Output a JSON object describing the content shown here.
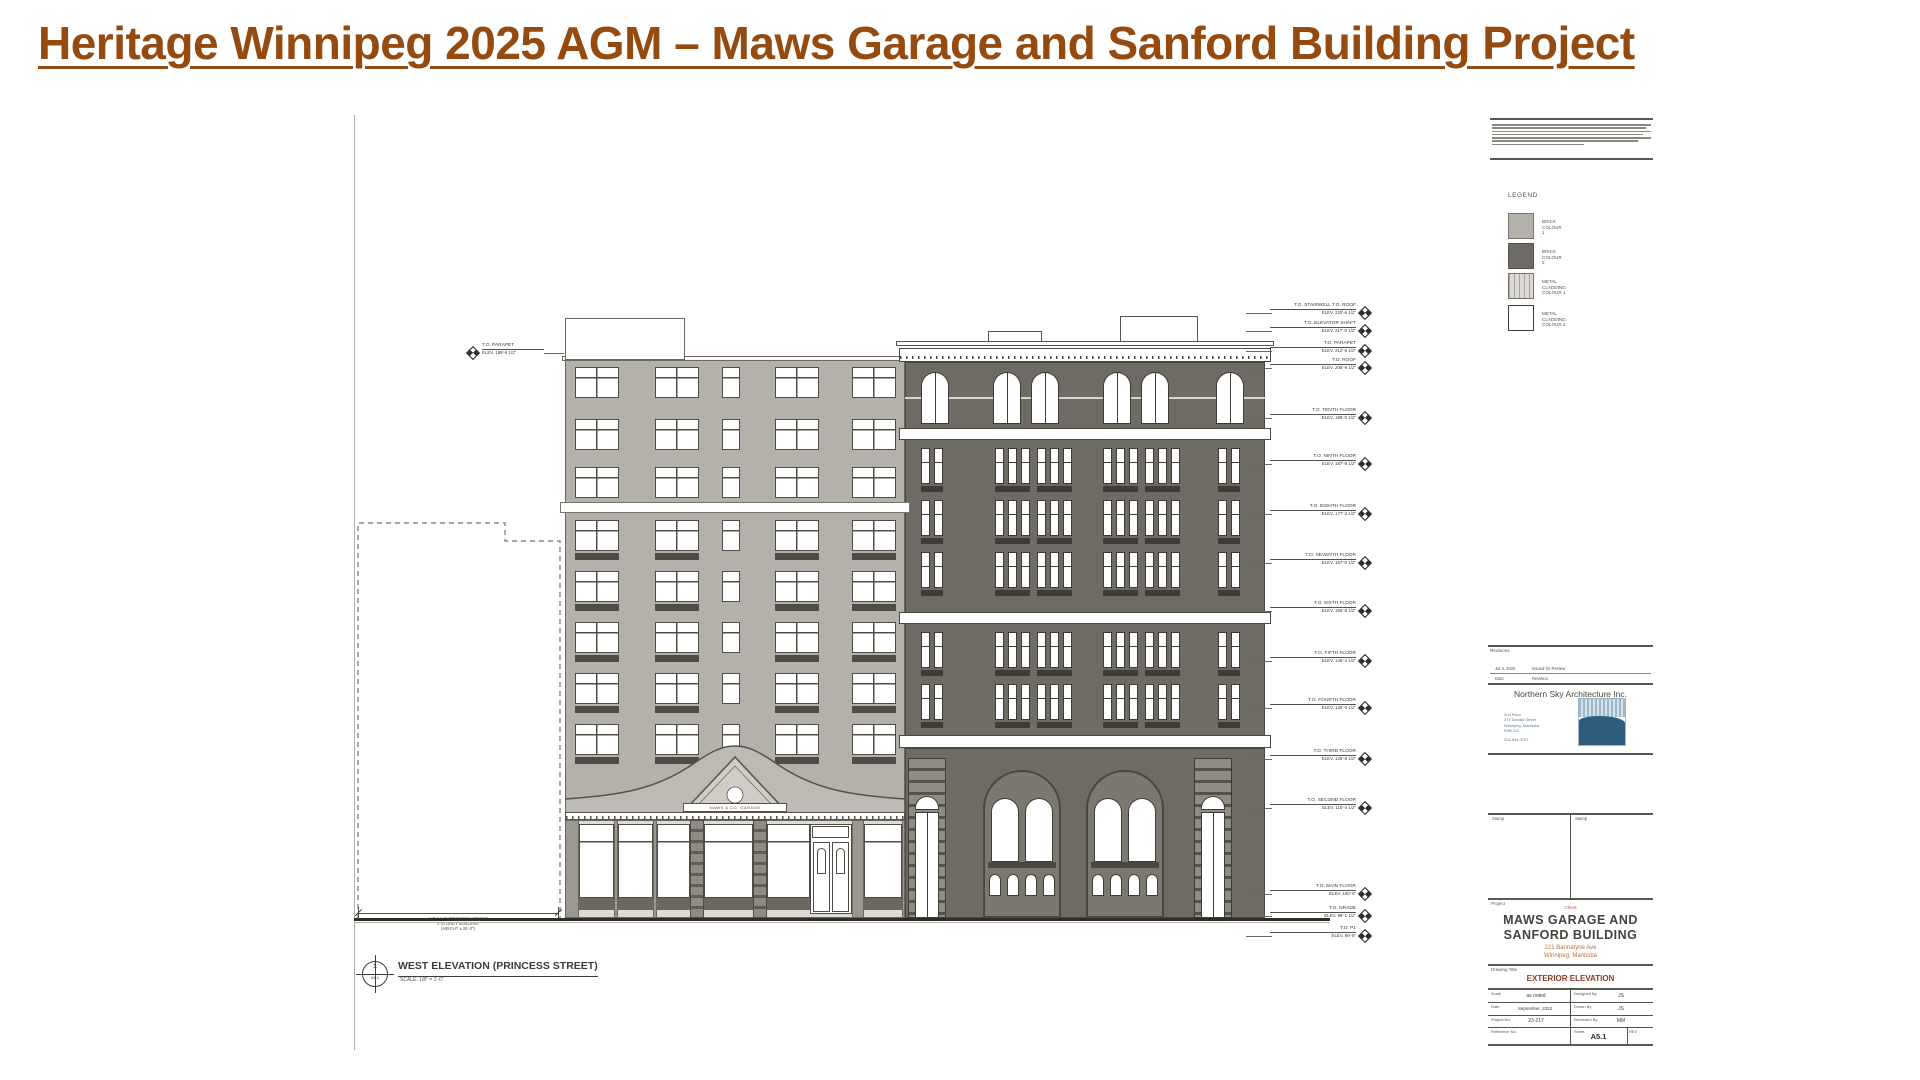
{
  "page": {
    "title": "Heritage Winnipeg 2025 AGM – Maws Garage and Sanford Building Project"
  },
  "colors": {
    "title_brown": "#954a10",
    "brick_colour_1": "#b4b1aa",
    "brick_colour_2": "#6e6b64",
    "accent_red": "#c0504d",
    "drawing_title_red": "#8a3a22",
    "logo_blue": "#2d5c7c"
  },
  "legend": {
    "title": "LEGEND",
    "items": [
      {
        "line1": "BRICK",
        "line2": "COLOUR 1"
      },
      {
        "line1": "BRICK",
        "line2": "COLOUR 2"
      },
      {
        "line1": "METAL CLADDING",
        "line2": "COLOUR 1"
      },
      {
        "line1": "METAL CLADDING",
        "line2": "COLOUR 2"
      }
    ]
  },
  "elevation": {
    "garage_sign": "MAWS & CO. GARAGE",
    "view": {
      "number": "1",
      "ref": "A5.1",
      "title": "WEST ELEVATION (PRINCESS STREET)",
      "scale": "SCALE: 1/8\" = 1'-0\""
    },
    "adjacent_note": [
      "147 & 149 PRINCESS STREET",
      "2 STOREY BUILDING",
      "(HEIGHT ± 26'-0\")"
    ],
    "left_marker": {
      "y": 352,
      "label": "T.O. PARAPET",
      "elev": "ELEV. 188'-6 1/2\""
    },
    "right_markers": [
      {
        "y": 312,
        "label": "T.O. STAIRWELL  T.O. ROOF",
        "elev": "ELEV. 220'-6 1/2\""
      },
      {
        "y": 330,
        "label": "T.O. ELEVATOR SHAFT",
        "elev": "ELEV. 217'-0 1/2\""
      },
      {
        "y": 350,
        "label": "T.O. PARAPET",
        "elev": "ELEV. 212'-6 1/2\""
      },
      {
        "y": 367,
        "label": "T.O. ROOF",
        "elev": "ELEV. 208'-9 1/2\""
      },
      {
        "y": 417,
        "label": "T.O. TENTH FLOOR",
        "elev": "ELEV. 198'-0 1/2\""
      },
      {
        "y": 463,
        "label": "T.O. NINTH FLOOR",
        "elev": "ELEV. 187'-8 1/2\""
      },
      {
        "y": 513,
        "label": "T.O. EIGHTH FLOOR",
        "elev": "ELEV. 177'-4 1/2\""
      },
      {
        "y": 562,
        "label": "T.O. SEVENTH FLOOR",
        "elev": "ELEV. 167'-0 1/2\""
      },
      {
        "y": 610,
        "label": "T.O. SIXTH FLOOR",
        "elev": "ELEV. 156'-8 1/2\""
      },
      {
        "y": 660,
        "label": "T.O. FIFTH FLOOR",
        "elev": "ELEV. 146'-4 1/2\""
      },
      {
        "y": 707,
        "label": "T.O. FOURTH FLOOR",
        "elev": "ELEV. 136'-0 1/2\""
      },
      {
        "y": 758,
        "label": "T.O. THIRD FLOOR",
        "elev": "ELEV. 125'-8 1/2\""
      },
      {
        "y": 807,
        "label": "T.O. SECOND FLOOR",
        "elev": "ELEV. 115'-4 1/2\""
      },
      {
        "y": 893,
        "label": "T.O. MAIN FLOOR",
        "elev": "ELEV. 100'-0\""
      },
      {
        "y": 915,
        "label": "T.O. GRADE",
        "elev": "ELEV. 99'-1 1/2\""
      },
      {
        "y": 935,
        "label": "T.O. P1",
        "elev": "ELEV. 89'-6\""
      }
    ]
  },
  "titleblock": {
    "revisions_label": "Revisions",
    "revision_date": "Jul 4, 2025",
    "revision_desc": "Issued for Review",
    "date_header": "Date",
    "revision_header": "Revision",
    "firm": "Northern Sky Architecture Inc.",
    "firm_address": [
      "2nd Floor",
      "374 Donald Street",
      "Winnipeg, Manitoba",
      "R3B 2J2",
      "204.944.0707"
    ],
    "stamp_label_1": "Stamp",
    "stamp_label_2": "Stamp",
    "project_label": "Project",
    "client_label": "Client",
    "project_name_1": "MAWS GARAGE AND",
    "project_name_2": "SANFORD BUILDING",
    "project_addr_1": "221 Bannatyne Ave",
    "project_addr_2": "Winnipeg, Manitoba",
    "drawing_title_label": "Drawing Title",
    "drawing_title": "EXTERIOR ELEVATION",
    "fields": {
      "scale_label": "Scale",
      "scale": "as noted",
      "designed_label": "Designed By",
      "designed": "JS",
      "date_label": "Date",
      "date": "September, 2023",
      "drawn_label": "Drawn By",
      "drawn": "JS",
      "project_no_label": "Project No.",
      "project_no": "23-217",
      "reviewed_label": "Reviewed By",
      "reviewed": "MM",
      "reference_label": "Reference No.",
      "sheet_label": "Sheet",
      "sheet": "A5.1",
      "rev_label": "REV"
    }
  }
}
